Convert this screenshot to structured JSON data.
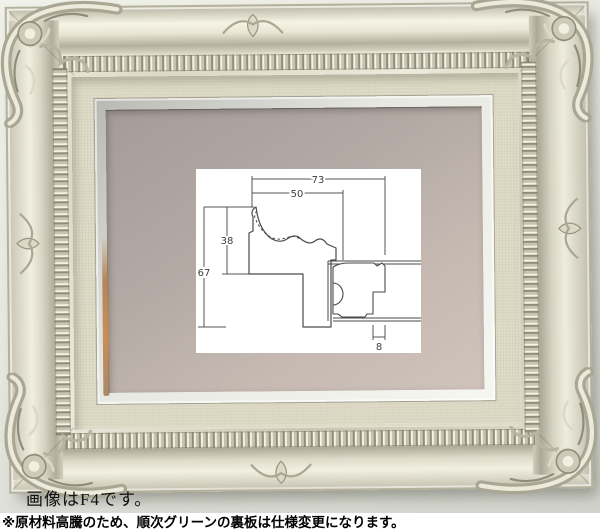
{
  "photo": {
    "caption": "画像はF4です。",
    "subject": "ornate-silver-baroque-frame-with-linen-liner"
  },
  "notice": {
    "text": "※原材料高騰のため、順次グリーンの裏板は仕様変更になります。"
  },
  "diagram": {
    "title": "frame-moulding-cross-section",
    "dimensions": {
      "overall_width": "73",
      "face_width": "50",
      "face_height": "38",
      "overall_height": "67",
      "lip_width": "8"
    }
  },
  "colors": {
    "wall": "#e7e9e1",
    "frame_silver": "#e9e6d6",
    "liner_linen": "#dcd8c3",
    "fillet_silver": "#eeeee8",
    "mat_taupe": "#b7ada7",
    "copper_accent": "#bb8350",
    "diagram_line": "#4a4a4a",
    "notice_bg": "#ffffff",
    "text": "#000000"
  }
}
